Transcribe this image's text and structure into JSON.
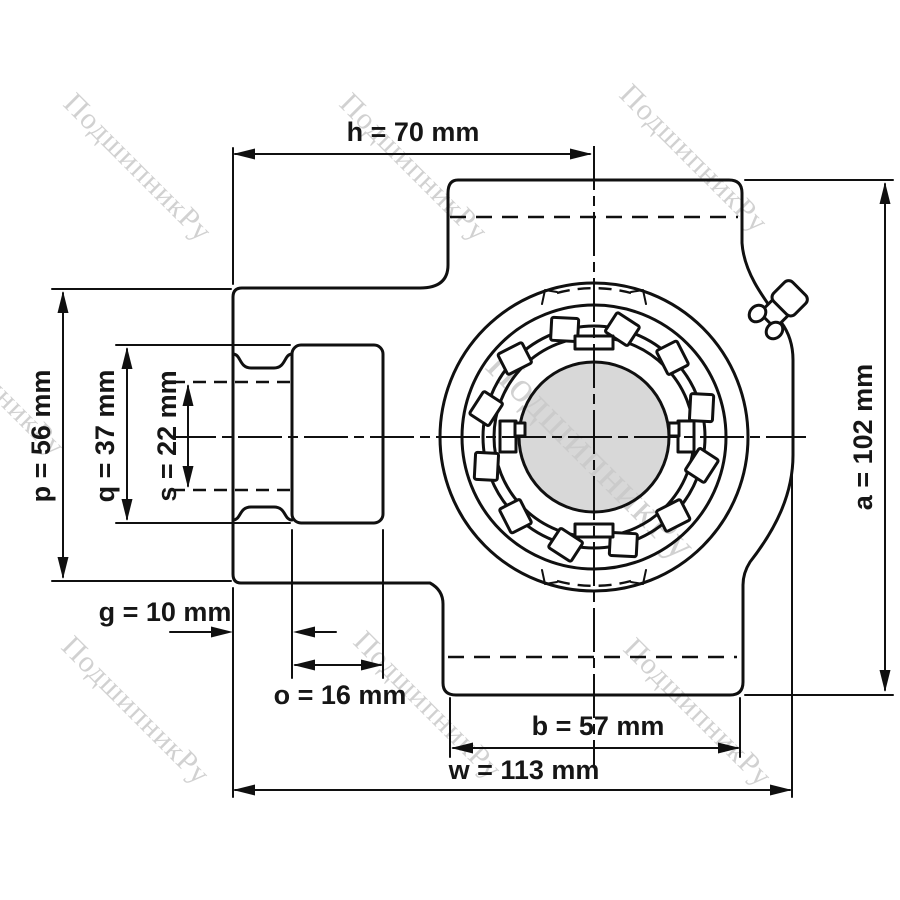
{
  "drawing": {
    "watermark": {
      "text": "ПодшипникРу",
      "color": "#c9c9c9"
    },
    "dimensions": {
      "h": "h = 70 mm",
      "a": "a = 102 mm",
      "p": "p = 56 mm",
      "q": "q = 37 mm",
      "s": "s = 22 mm",
      "g": "g = 10 mm",
      "o": "o = 16 mm",
      "b": "b = 57 mm",
      "w": "w = 113 mm"
    },
    "colors": {
      "line": "#101010",
      "bore_fill": "#d8d8d8",
      "watermark": "#c9c9c9",
      "background": "#ffffff"
    }
  }
}
